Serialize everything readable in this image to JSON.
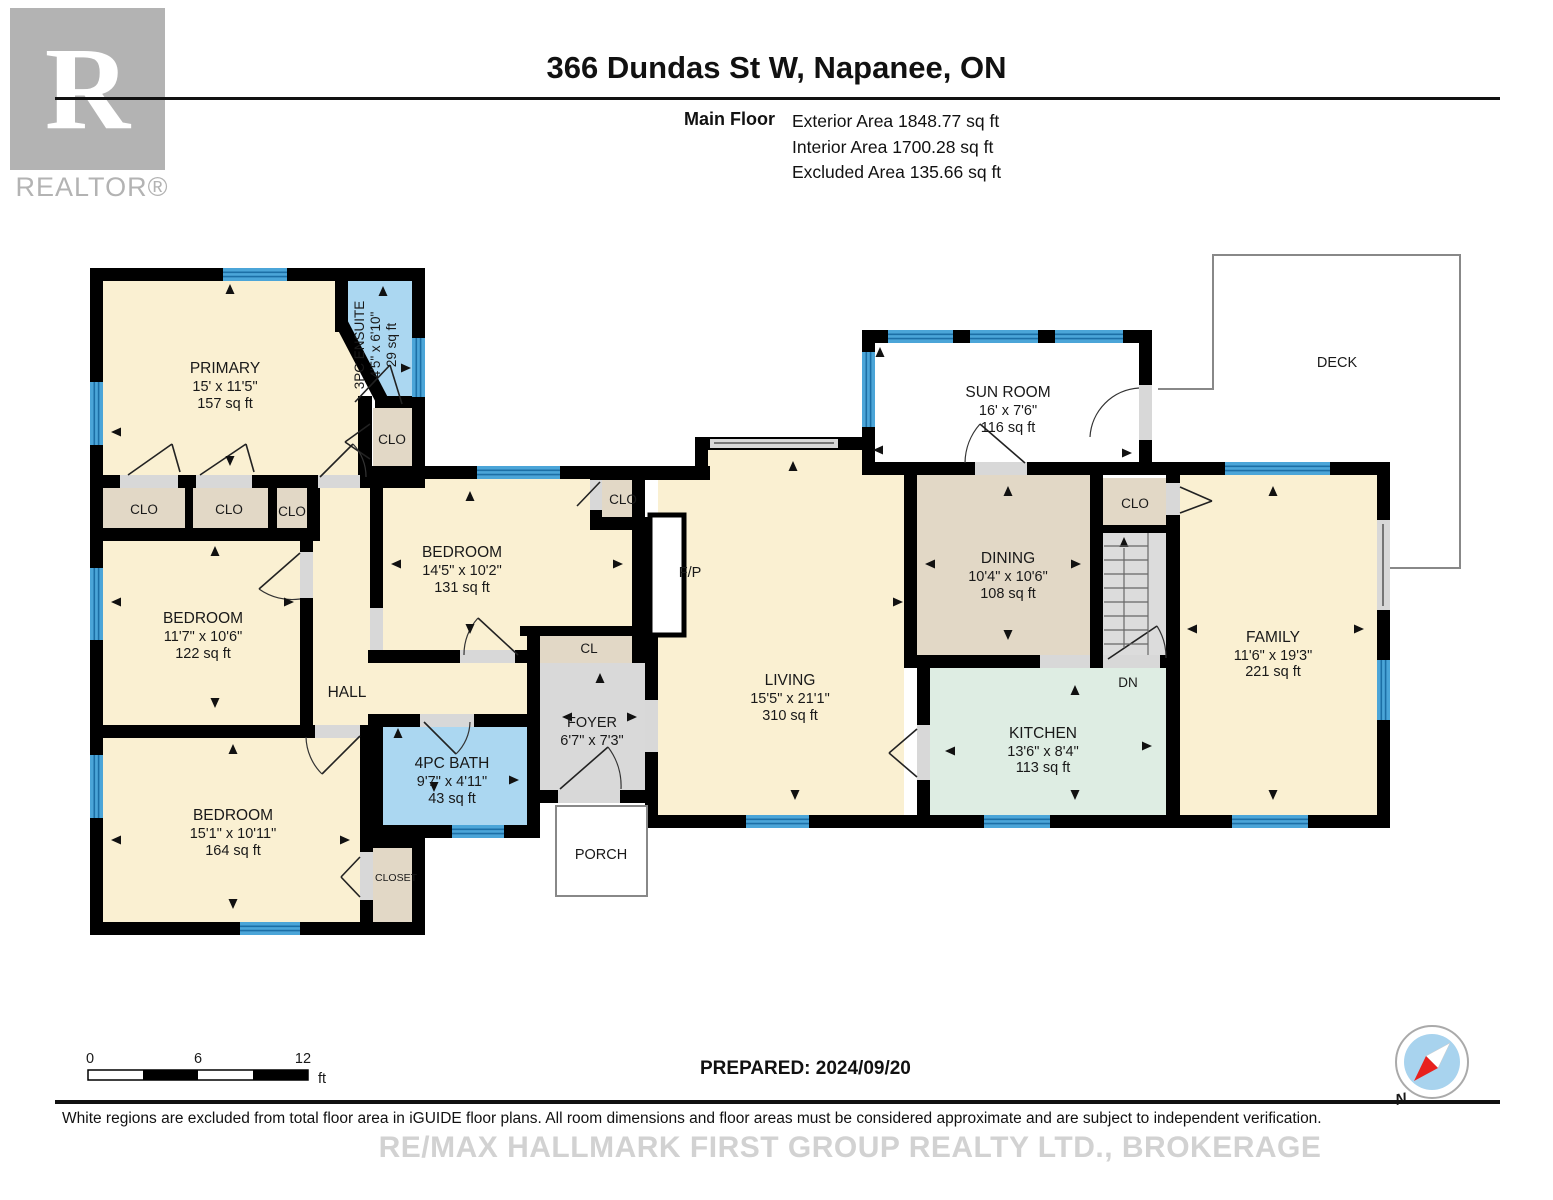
{
  "logo": {
    "letter": "R",
    "brand": "REALTOR®"
  },
  "header": {
    "title": "366 Dundas St W, Napanee, ON",
    "floor_label": "Main Floor",
    "area_lines": [
      "Exterior Area 1848.77 sq ft",
      "Interior Area 1700.28 sq ft",
      "Excluded Area 135.66 sq ft"
    ]
  },
  "rooms": {
    "primary": {
      "name": "PRIMARY",
      "dims": "15' x 11'5\"",
      "area": "157 sq ft"
    },
    "ensuite": {
      "name": "3PC ENSUITE",
      "dims": "4'5\" x 6'10\"",
      "area": "29 sq ft"
    },
    "bedroom_center": {
      "name": "BEDROOM",
      "dims": "14'5\" x 10'2\"",
      "area": "131 sq ft"
    },
    "bedroom_mid": {
      "name": "BEDROOM",
      "dims": "11'7\" x 10'6\"",
      "area": "122 sq ft"
    },
    "bedroom_lower": {
      "name": "BEDROOM",
      "dims": "15'1\" x 10'11\"",
      "area": "164 sq ft"
    },
    "sun_room": {
      "name": "SUN ROOM",
      "dims": "16' x 7'6\"",
      "area": "116 sq ft"
    },
    "dining": {
      "name": "DINING",
      "dims": "10'4\" x 10'6\"",
      "area": "108 sq ft"
    },
    "family": {
      "name": "FAMILY",
      "dims": "11'6\" x 19'3\"",
      "area": "221 sq ft"
    },
    "living": {
      "name": "LIVING",
      "dims": "15'5\" x 21'1\"",
      "area": "310 sq ft"
    },
    "kitchen": {
      "name": "KITCHEN",
      "dims": "13'6\" x 8'4\"",
      "area": "113 sq ft"
    },
    "bath": {
      "name": "4PC BATH",
      "dims": "9'7\" x 4'11\"",
      "area": "43 sq ft"
    },
    "foyer": {
      "name": "FOYER",
      "dims": "6'7\" x 7'3\""
    }
  },
  "small_labels": {
    "hall": "HALL",
    "deck": "DECK",
    "porch": "PORCH",
    "closet": "CLOSET",
    "clo": "CLO",
    "cl": "CL",
    "fp": "F/P",
    "dn": "DN"
  },
  "scale_bar": {
    "tick0": "0",
    "tick1": "6",
    "tick2": "12",
    "unit": "ft"
  },
  "compass": {
    "north_label": "N"
  },
  "footer": {
    "prepared": "PREPARED: 2024/09/20",
    "disclaimer": "White regions are excluded from total floor area in iGUIDE floor plans. All room dimensions and floor areas must be considered approximate and are subject to independent verification.",
    "watermark": "RE/MAX HALLMARK FIRST GROUP REALTY LTD., BROKERAGE"
  },
  "colors": {
    "wall": "#000000",
    "room_cream": "#FAF0D2",
    "closet_beige": "#E2D8C6",
    "bath_blue": "#ABD7F1",
    "kitchen_mint": "#DEEDE3",
    "floor_gray": "#D9D9D9",
    "window_blue": "#4BA5D8",
    "logo_gray": "#B3B3B3",
    "watermark_gray": "#D2D2D2",
    "compass_blue": "#A8D3EE",
    "compass_red": "#E8211D"
  }
}
